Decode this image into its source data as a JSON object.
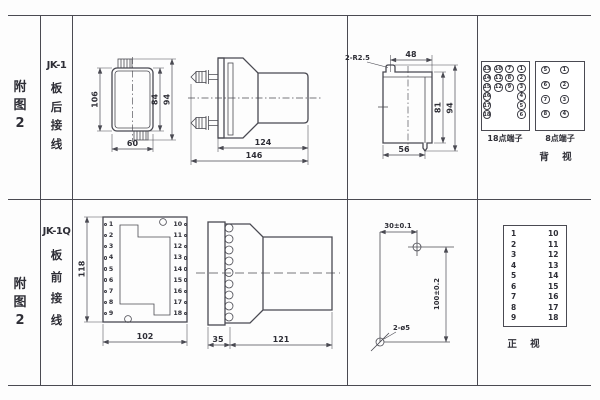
{
  "row1": {
    "fig": {
      "c1": "附",
      "c2": "图",
      "c3": "2"
    },
    "model": "JK-1",
    "wiring": {
      "c1": "板",
      "c2": "后",
      "c3": "接",
      "c4": "线"
    },
    "top_view": {
      "height": "106",
      "width": "60",
      "inner_height": "84",
      "outer_height": "94"
    },
    "side_view": {
      "body_length": "124",
      "total_length": "146"
    },
    "cutout_view": {
      "radius_note": "2-R2.5",
      "top_width": "48",
      "inner_height": "81",
      "outer_height": "94",
      "bottom_width": "56"
    },
    "terminals": {
      "box18": {
        "label": "18点端子",
        "col1": [
          "13",
          "14",
          "15",
          "16",
          "17",
          "18"
        ],
        "col2": [
          "10",
          "11",
          "12"
        ],
        "col3": [
          "7",
          "8",
          "9"
        ],
        "col4": [
          "1",
          "2",
          "3",
          "4",
          "5",
          "6"
        ]
      },
      "box8": {
        "label": "8点端子",
        "col1": [
          "5",
          "6",
          "7",
          "8"
        ],
        "col2": [
          "1",
          "2",
          "3",
          "4"
        ]
      },
      "view_label": "背 视"
    }
  },
  "row2": {
    "fig": {
      "c1": "附",
      "c2": "图",
      "c3": "2"
    },
    "model": "JK-1Q",
    "wiring": {
      "c1": "板",
      "c2": "前",
      "c3": "接",
      "c4": "线"
    },
    "front_plate": {
      "height": "118",
      "width": "102",
      "left_terminals": [
        "1",
        "2",
        "3",
        "4",
        "5",
        "6",
        "7",
        "8",
        "9"
      ],
      "right_terminals": [
        "10",
        "11",
        "12",
        "13",
        "14",
        "15",
        "16",
        "17",
        "18"
      ]
    },
    "side_view": {
      "plate_depth": "35",
      "body_length": "121"
    },
    "drill_view": {
      "hole_spacing_x": "30±0.1",
      "hole_spacing_y": "100±0.2",
      "holes_note": "2-ø5"
    },
    "front_view": {
      "left": [
        "1",
        "2",
        "3",
        "4",
        "5",
        "6",
        "7",
        "8",
        "9"
      ],
      "right": [
        "10",
        "11",
        "12",
        "13",
        "14",
        "15",
        "16",
        "17",
        "18"
      ],
      "view_label": "正 视"
    }
  }
}
